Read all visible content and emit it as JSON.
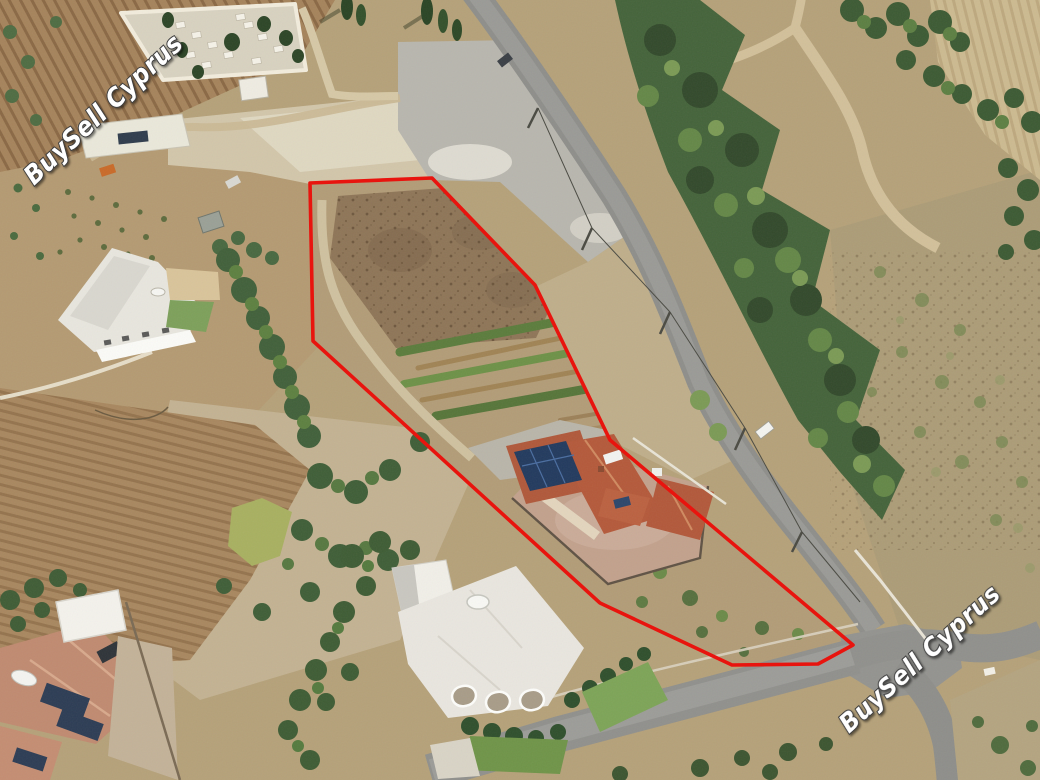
{
  "photo": {
    "kind": "aerial-photograph",
    "subject": "aerial view of a building plot with detached house, gardens and roads, plot outlined in red",
    "boundary": {
      "color": "#e8140e"
    },
    "watermarks": [
      {
        "position": "top-left",
        "text": "BuySell Cyprus"
      },
      {
        "position": "bottom-right",
        "text": "BuySell Cyprus"
      }
    ]
  }
}
